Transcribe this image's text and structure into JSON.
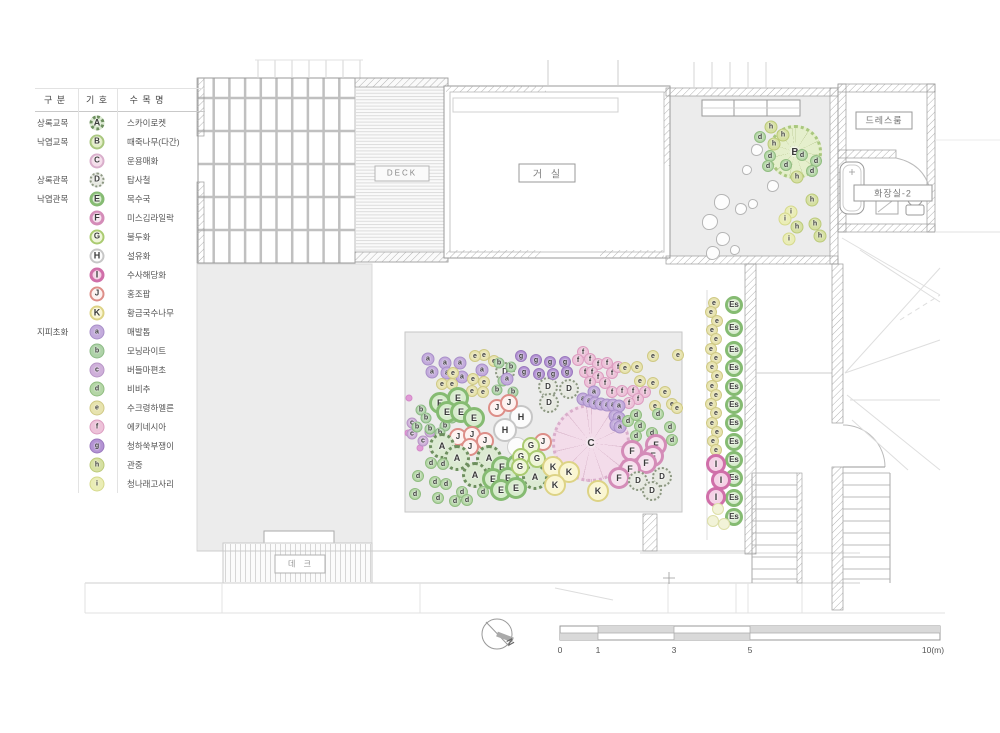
{
  "legend": {
    "headers": [
      "구 분",
      "기 호",
      "수 목 명"
    ],
    "rows": [
      {
        "cat": "상록교목",
        "sym": "A",
        "name": "스카이로켓"
      },
      {
        "cat": "낙엽교목",
        "sym": "B",
        "name": "때죽나무(다간)"
      },
      {
        "cat": "",
        "sym": "C",
        "name": "운용매화"
      },
      {
        "cat": "상록관목",
        "sym": "D",
        "name": "탑사철"
      },
      {
        "cat": "낙엽관목",
        "sym": "E",
        "name": "목수국"
      },
      {
        "cat": "",
        "sym": "F",
        "name": "미스김라일락"
      },
      {
        "cat": "",
        "sym": "G",
        "name": "불두화"
      },
      {
        "cat": "",
        "sym": "H",
        "name": "설유화"
      },
      {
        "cat": "",
        "sym": "I",
        "name": "수사해당화"
      },
      {
        "cat": "",
        "sym": "J",
        "name": "홍조팝"
      },
      {
        "cat": "",
        "sym": "K",
        "name": "황금국수나무"
      },
      {
        "cat": "지피초화",
        "sym": "a",
        "name": "매발톱"
      },
      {
        "cat": "",
        "sym": "b",
        "name": "모닝라이트"
      },
      {
        "cat": "",
        "sym": "c",
        "name": "버들마편초"
      },
      {
        "cat": "",
        "sym": "d",
        "name": "비비추"
      },
      {
        "cat": "",
        "sym": "e",
        "name": "수크령하멜른"
      },
      {
        "cat": "",
        "sym": "f",
        "name": "에키네시아"
      },
      {
        "cat": "",
        "sym": "g",
        "name": "청하쑥부쟁이"
      },
      {
        "cat": "",
        "sym": "h",
        "name": "관중"
      },
      {
        "cat": "",
        "sym": "i",
        "name": "청나래고사리"
      }
    ]
  },
  "rooms": {
    "deck_en": "DECK",
    "living": "거 실",
    "dressroom": "드레스룸",
    "bathroom": "화장실-2",
    "deck_kr": "데 크"
  },
  "compass": {
    "label": "N"
  },
  "scalebar": {
    "labels": [
      "0",
      "1",
      "3",
      "5",
      "10(m)"
    ],
    "positions": [
      560,
      598,
      674,
      750,
      933
    ]
  },
  "palette": {
    "A": {
      "fill": "#dcead2",
      "stroke": "#6d8f5e",
      "w": 3,
      "dash": true,
      "r": 13,
      "fs": 9
    },
    "D": {
      "fill": "#e7e9e2",
      "stroke": "#8d9883",
      "w": 2.5,
      "dash": true,
      "r": 10,
      "fs": 8
    },
    "E": {
      "fill": "#d8ecce",
      "stroke": "#85bb72",
      "w": 3,
      "r": 11,
      "fs": 9
    },
    "Es": {
      "fill": "#d8ecce",
      "stroke": "#85bb72",
      "w": 3,
      "r": 9,
      "fs": 8
    },
    "F": {
      "fill": "#f6e2ee",
      "stroke": "#d48cb8",
      "w": 3,
      "r": 11,
      "fs": 9
    },
    "G": {
      "fill": "#eef5d6",
      "stroke": "#aacb70",
      "w": 2.5,
      "r": 9,
      "fs": 8
    },
    "H": {
      "fill": "#fcfcfc",
      "stroke": "#c6c6c6",
      "w": 2,
      "r": 12,
      "fs": 9
    },
    "H0": {
      "fill": "#fcfcfc",
      "stroke": "#cecece",
      "w": 1.5,
      "r": 10,
      "label": false
    },
    "I": {
      "fill": "#f5d2e6",
      "stroke": "#d06fa9",
      "w": 3,
      "r": 10,
      "fs": 9
    },
    "J": {
      "fill": "#fdf2f0",
      "stroke": "#dd8e88",
      "w": 2.5,
      "r": 9,
      "fs": 8
    },
    "K": {
      "fill": "#faf6d2",
      "stroke": "#ddd385",
      "w": 2.5,
      "r": 11,
      "fs": 9
    },
    "B": {
      "fill": "#e3eec6",
      "stroke": "#a9c77e",
      "w": 2,
      "r": 8,
      "fs": 8
    },
    "C": {
      "fill": "#f4dcea",
      "stroke": "#d9aecb",
      "w": 2,
      "r": 8,
      "fs": 8
    },
    "a": {
      "fill": "#c3abdc",
      "stroke": "#a88fc8",
      "w": 1.5,
      "r": 6.5,
      "fs": 7
    },
    "b": {
      "fill": "#aed2a8",
      "stroke": "#8cba85",
      "w": 1.5,
      "r": 5.5,
      "fs": 7
    },
    "c": {
      "fill": "#cfb0da",
      "stroke": "#b795c6",
      "w": 1.5,
      "r": 5.5,
      "fs": 7
    },
    "d": {
      "fill": "#b4d6a6",
      "stroke": "#90bd80",
      "w": 1.5,
      "r": 6,
      "fs": 7
    },
    "e": {
      "fill": "#e7e3ae",
      "stroke": "#cfc985",
      "w": 1.5,
      "r": 6,
      "fs": 7
    },
    "f": {
      "fill": "#edc2d9",
      "stroke": "#dc9dc0",
      "w": 1.5,
      "r": 6,
      "fs": 7
    },
    "g": {
      "fill": "#b393d3",
      "stroke": "#9a78be",
      "w": 1.5,
      "r": 6,
      "fs": 7
    },
    "h": {
      "fill": "#d6e0a2",
      "stroke": "#bcca79",
      "w": 1.5,
      "r": 6.5,
      "fs": 7
    },
    "i": {
      "fill": "#eaedb6",
      "stroke": "#d5d98b",
      "w": 1.5,
      "r": 6.5,
      "fs": 7
    },
    "i0": {
      "fill": "#f2f3d8",
      "stroke": "#dddfa8",
      "w": 1.5,
      "r": 6,
      "label": false
    },
    "rock": {
      "fill": "#fdfdfd",
      "stroke": "#b5b5b5",
      "w": 1,
      "r": 7,
      "label": false
    },
    "dot": {
      "fill": "#e09ad6",
      "stroke": "#d489c9",
      "w": 1,
      "r": 3.5,
      "label": false
    }
  },
  "plan": {
    "trees": [
      {
        "sym": "B",
        "x": 795,
        "y": 152,
        "r": 27,
        "fill": "#e5efcc",
        "stroke": "#a9c77e",
        "spoke": "rgba(150,170,100,0.45)"
      },
      {
        "sym": "C",
        "x": 591,
        "y": 443,
        "r": 39,
        "fill": "#f3dcea",
        "stroke": "#d9aecb",
        "spoke": "rgba(190,140,170,0.4)"
      }
    ],
    "rocks": [
      [
        757,
        150,
        6
      ],
      [
        773,
        186,
        6
      ],
      [
        747,
        170,
        5
      ],
      [
        722,
        202,
        8
      ],
      [
        741,
        209,
        6
      ],
      [
        753,
        204,
        5
      ],
      [
        710,
        222,
        8
      ],
      [
        723,
        239,
        7
      ],
      [
        713,
        253,
        7
      ],
      [
        735,
        250,
        5
      ]
    ],
    "items": [
      [
        "h",
        771,
        127
      ],
      [
        "d",
        760,
        137
      ],
      [
        "h",
        783,
        135
      ],
      [
        "h",
        774,
        144
      ],
      [
        "d",
        770,
        156
      ],
      [
        "d",
        802,
        155
      ],
      [
        "d",
        768,
        166
      ],
      [
        "d",
        786,
        165
      ],
      [
        "d",
        816,
        161
      ],
      [
        "d",
        812,
        171
      ],
      [
        "h",
        797,
        177
      ],
      [
        "h",
        812,
        200
      ],
      [
        "i",
        791,
        212
      ],
      [
        "i",
        785,
        219
      ],
      [
        "h",
        797,
        227
      ],
      [
        "h",
        815,
        224
      ],
      [
        "i",
        789,
        239
      ],
      [
        "h",
        820,
        236
      ],
      [
        "e",
        714,
        303
      ],
      [
        "e",
        711,
        312
      ],
      [
        "e",
        717,
        321
      ],
      [
        "e",
        712,
        330
      ],
      [
        "e",
        716,
        339
      ],
      [
        "e",
        711,
        349
      ],
      [
        "e",
        716,
        358
      ],
      [
        "e",
        712,
        367
      ],
      [
        "e",
        717,
        376
      ],
      [
        "e",
        712,
        386
      ],
      [
        "e",
        716,
        395
      ],
      [
        "e",
        711,
        404
      ],
      [
        "e",
        716,
        413
      ],
      [
        "e",
        712,
        423
      ],
      [
        "e",
        717,
        432
      ],
      [
        "e",
        713,
        441
      ],
      [
        "e",
        716,
        450
      ],
      [
        "Es",
        734,
        305
      ],
      [
        "Es",
        734,
        328
      ],
      [
        "Es",
        734,
        350
      ],
      [
        "Es",
        734,
        368
      ],
      [
        "Es",
        734,
        387
      ],
      [
        "Es",
        734,
        405
      ],
      [
        "Es",
        734,
        423
      ],
      [
        "Es",
        734,
        442
      ],
      [
        "Es",
        734,
        460
      ],
      [
        "Es",
        734,
        478
      ],
      [
        "Es",
        734,
        498
      ],
      [
        "Es",
        734,
        517
      ],
      [
        "I",
        716,
        464
      ],
      [
        "I",
        721,
        480
      ],
      [
        "I",
        716,
        497
      ],
      [
        "i0",
        718,
        509
      ],
      [
        "i0",
        713,
        521
      ],
      [
        "i0",
        724,
        524
      ],
      [
        "dot",
        409,
        398
      ],
      [
        "dot",
        408,
        433
      ],
      [
        "dot",
        445,
        421
      ],
      [
        "dot",
        420,
        448
      ],
      [
        "dot",
        433,
        450
      ],
      [
        "c",
        412,
        423
      ],
      [
        "c",
        430,
        432
      ],
      [
        "c",
        412,
        434
      ],
      [
        "c",
        423,
        441
      ],
      [
        "c",
        437,
        445
      ],
      [
        "b",
        421,
        410
      ],
      [
        "b",
        426,
        418
      ],
      [
        "b",
        445,
        426
      ],
      [
        "b",
        452,
        418
      ],
      [
        "b",
        417,
        427
      ],
      [
        "b",
        430,
        429
      ],
      [
        "b",
        440,
        433
      ],
      [
        "a",
        428,
        359
      ],
      [
        "a",
        445,
        363
      ],
      [
        "a",
        460,
        363
      ],
      [
        "a",
        432,
        372
      ],
      [
        "a",
        447,
        373
      ],
      [
        "a",
        482,
        370
      ],
      [
        "a",
        462,
        377
      ],
      [
        "e",
        484,
        355
      ],
      [
        "e",
        494,
        361
      ],
      [
        "e",
        475,
        356
      ],
      [
        "e",
        453,
        373
      ],
      [
        "e",
        473,
        379
      ],
      [
        "e",
        484,
        382
      ],
      [
        "e",
        442,
        384
      ],
      [
        "e",
        452,
        384
      ],
      [
        "e",
        472,
        391
      ],
      [
        "e",
        483,
        392
      ],
      [
        "e",
        462,
        396
      ],
      [
        "H",
        521,
        417
      ],
      [
        "H",
        505,
        430
      ],
      [
        "H0",
        517,
        447
      ],
      [
        "H0",
        533,
        448
      ],
      [
        "E",
        440,
        403
      ],
      [
        "E",
        458,
        398
      ],
      [
        "E",
        447,
        412
      ],
      [
        "E",
        461,
        412
      ],
      [
        "E",
        474,
        418
      ],
      [
        "D",
        505,
        372
      ],
      [
        "D",
        548,
        387
      ],
      [
        "D",
        569,
        389
      ],
      [
        "D",
        549,
        403
      ],
      [
        "g",
        521,
        356
      ],
      [
        "g",
        536,
        360
      ],
      [
        "g",
        550,
        362
      ],
      [
        "g",
        565,
        362
      ],
      [
        "g",
        524,
        372
      ],
      [
        "g",
        539,
        374
      ],
      [
        "g",
        553,
        374
      ],
      [
        "g",
        567,
        372
      ],
      [
        "b",
        499,
        363
      ],
      [
        "b",
        511,
        367
      ],
      [
        "b",
        503,
        381
      ],
      [
        "b",
        513,
        392
      ],
      [
        "b",
        497,
        390
      ],
      [
        "a",
        507,
        379
      ],
      [
        "f",
        583,
        352
      ],
      [
        "f",
        578,
        360
      ],
      [
        "f",
        590,
        359
      ],
      [
        "f",
        598,
        364
      ],
      [
        "f",
        607,
        363
      ],
      [
        "f",
        585,
        372
      ],
      [
        "f",
        592,
        372
      ],
      [
        "f",
        598,
        377
      ],
      [
        "f",
        590,
        382
      ],
      [
        "f",
        605,
        383
      ],
      [
        "f",
        612,
        373
      ],
      [
        "f",
        618,
        367
      ],
      [
        "f",
        612,
        392
      ],
      [
        "f",
        622,
        391
      ],
      [
        "f",
        633,
        391
      ],
      [
        "f",
        645,
        392
      ],
      [
        "f",
        638,
        399
      ],
      [
        "f",
        629,
        403
      ],
      [
        "a",
        594,
        392
      ],
      [
        "a",
        583,
        399
      ],
      [
        "a",
        589,
        401
      ],
      [
        "a",
        595,
        403
      ],
      [
        "a",
        601,
        404
      ],
      [
        "a",
        607,
        405
      ],
      [
        "a",
        613,
        405
      ],
      [
        "a",
        619,
        406
      ],
      [
        "a",
        615,
        416
      ],
      [
        "a",
        619,
        418
      ],
      [
        "a",
        616,
        425
      ],
      [
        "a",
        620,
        427
      ],
      [
        "e",
        625,
        368
      ],
      [
        "e",
        637,
        367
      ],
      [
        "e",
        653,
        356
      ],
      [
        "e",
        678,
        355
      ],
      [
        "e",
        640,
        381
      ],
      [
        "e",
        653,
        383
      ],
      [
        "e",
        665,
        392
      ],
      [
        "e",
        672,
        404
      ],
      [
        "e",
        655,
        406
      ],
      [
        "e",
        677,
        408
      ],
      [
        "d",
        628,
        421
      ],
      [
        "d",
        636,
        415
      ],
      [
        "d",
        640,
        426
      ],
      [
        "d",
        636,
        436
      ],
      [
        "d",
        652,
        433
      ],
      [
        "d",
        654,
        444
      ],
      [
        "d",
        658,
        414
      ],
      [
        "d",
        670,
        427
      ],
      [
        "d",
        672,
        440
      ],
      [
        "J",
        497,
        408
      ],
      [
        "J",
        509,
        403
      ],
      [
        "J",
        458,
        437
      ],
      [
        "J",
        472,
        435
      ],
      [
        "J",
        485,
        441
      ],
      [
        "J",
        470,
        447
      ],
      [
        "J",
        543,
        442
      ],
      [
        "A",
        442,
        446
      ],
      [
        "A",
        457,
        458
      ],
      [
        "A",
        489,
        458
      ],
      [
        "A",
        475,
        475
      ],
      [
        "A",
        535,
        477
      ],
      [
        "d",
        431,
        463
      ],
      [
        "d",
        443,
        464
      ],
      [
        "d",
        418,
        476
      ],
      [
        "d",
        435,
        482
      ],
      [
        "d",
        446,
        484
      ],
      [
        "d",
        415,
        494
      ],
      [
        "d",
        438,
        498
      ],
      [
        "d",
        455,
        501
      ],
      [
        "d",
        462,
        492
      ],
      [
        "d",
        467,
        500
      ],
      [
        "d",
        483,
        492
      ],
      [
        "E",
        502,
        467
      ],
      [
        "E",
        517,
        465
      ],
      [
        "E",
        493,
        479
      ],
      [
        "E",
        508,
        478
      ],
      [
        "E",
        501,
        490
      ],
      [
        "E",
        516,
        488
      ],
      [
        "G",
        531,
        446
      ],
      [
        "G",
        521,
        457
      ],
      [
        "G",
        537,
        459
      ],
      [
        "G",
        520,
        467
      ],
      [
        "K",
        553,
        467
      ],
      [
        "K",
        569,
        472
      ],
      [
        "K",
        555,
        485
      ],
      [
        "K",
        598,
        491
      ],
      [
        "F",
        632,
        451
      ],
      [
        "F",
        656,
        445
      ],
      [
        "F",
        653,
        456
      ],
      [
        "F",
        646,
        463
      ],
      [
        "F",
        630,
        469
      ],
      [
        "F",
        619,
        478
      ],
      [
        "D",
        638,
        481
      ],
      [
        "D",
        662,
        477
      ],
      [
        "D",
        652,
        491
      ]
    ]
  }
}
